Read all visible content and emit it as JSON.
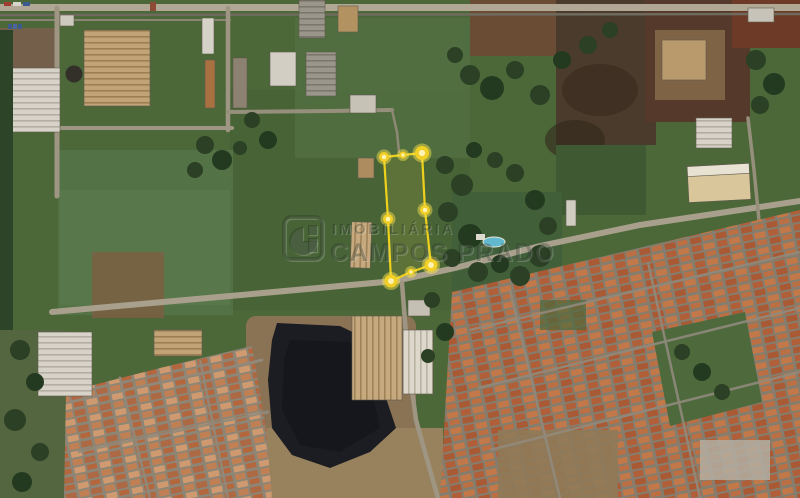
{
  "image": {
    "kind": "satellite-aerial-photo",
    "description": "aerial map of industrial and residential neighborhood with highlighted land plot"
  },
  "watermark": {
    "line1": "IMOBILIÁRIA",
    "line2": "CAMPOS PRADO",
    "logo": "campos-prado-logo"
  },
  "plot_overlay": {
    "stroke_color": "#eed11c",
    "fill_color": "rgba(250,225,70,0.12)",
    "vertex_fill": "#f2cf25",
    "vertex_glow": "rgba(255,230,80,0.45)",
    "vertex_core": "#fcf3b4",
    "vertices": [
      {
        "x": 384,
        "y": 157,
        "r": 5
      },
      {
        "x": 403,
        "y": 155,
        "r": 3.5
      },
      {
        "x": 422,
        "y": 153,
        "r": 7
      },
      {
        "x": 425,
        "y": 210,
        "r": 5
      },
      {
        "x": 431,
        "y": 265,
        "r": 6.5
      },
      {
        "x": 411,
        "y": 272,
        "r": 3.5
      },
      {
        "x": 391,
        "y": 281,
        "r": 6.5
      },
      {
        "x": 388,
        "y": 219,
        "r": 5
      }
    ]
  },
  "map_palette": {
    "field_green": "#4c6839",
    "dark_green": "#3f5c31",
    "tree_green": "#2b4024",
    "road_gray": "#a8a08c",
    "roof_orange": "#b5643f",
    "roof_white": "#d7d3c8",
    "roof_tan": "#c2a377",
    "burnt_field": "#1b1d22",
    "pool_blue": "#62b8cc",
    "dirt_brown": "#8a7354"
  }
}
